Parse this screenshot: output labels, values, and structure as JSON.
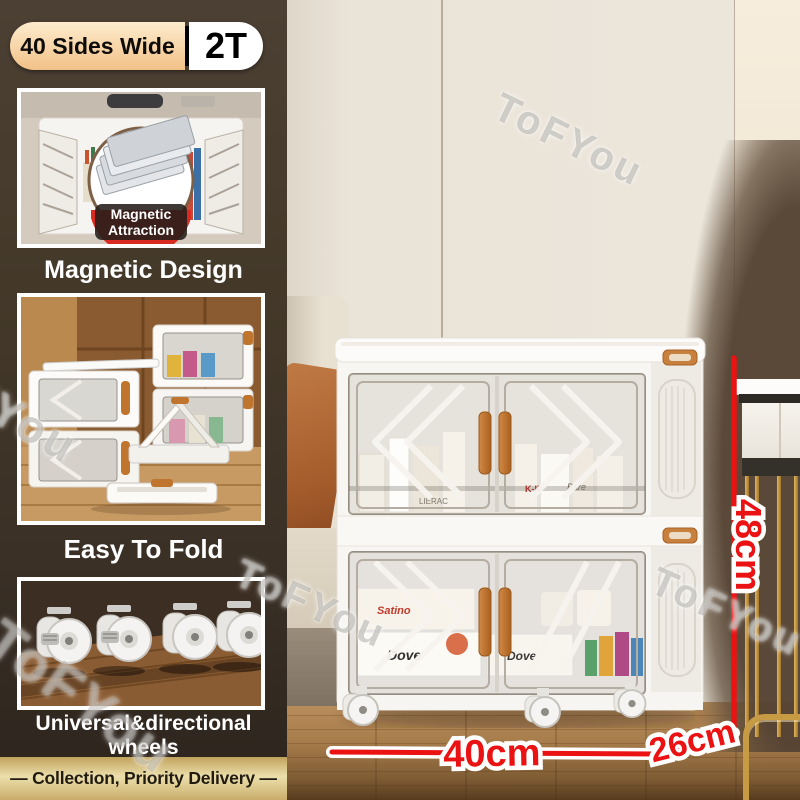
{
  "badge": {
    "left_label": "40 Sides Wide",
    "right_label": "2T"
  },
  "sidebar": {
    "panel1": {
      "caption": "Magnetic Design",
      "inset": {
        "line1": "Magnetic",
        "line2": "Attraction"
      }
    },
    "panel2": {
      "caption": "Easy To Fold"
    },
    "panel3": {
      "caption_line1": "Universal&directional",
      "caption_line2": "wheels"
    },
    "footer": "— Collection, Priority Delivery —"
  },
  "annotations": {
    "height_label": "48cm",
    "width_label": "40cm",
    "depth_label": "26cm"
  },
  "watermark": {
    "text": "ToFYou"
  },
  "photo_labels": {
    "top_shelf": [
      "LIERAC",
      "K-II",
      "Bare"
    ],
    "bottom_shelf": [
      "Satino",
      "Dove",
      "Dove"
    ]
  },
  "colors": {
    "accent_red": "#ea1213",
    "badge_peach": "#f2c188",
    "gold_bar": "#ecdfab",
    "handle_orange": "#c0752f"
  }
}
